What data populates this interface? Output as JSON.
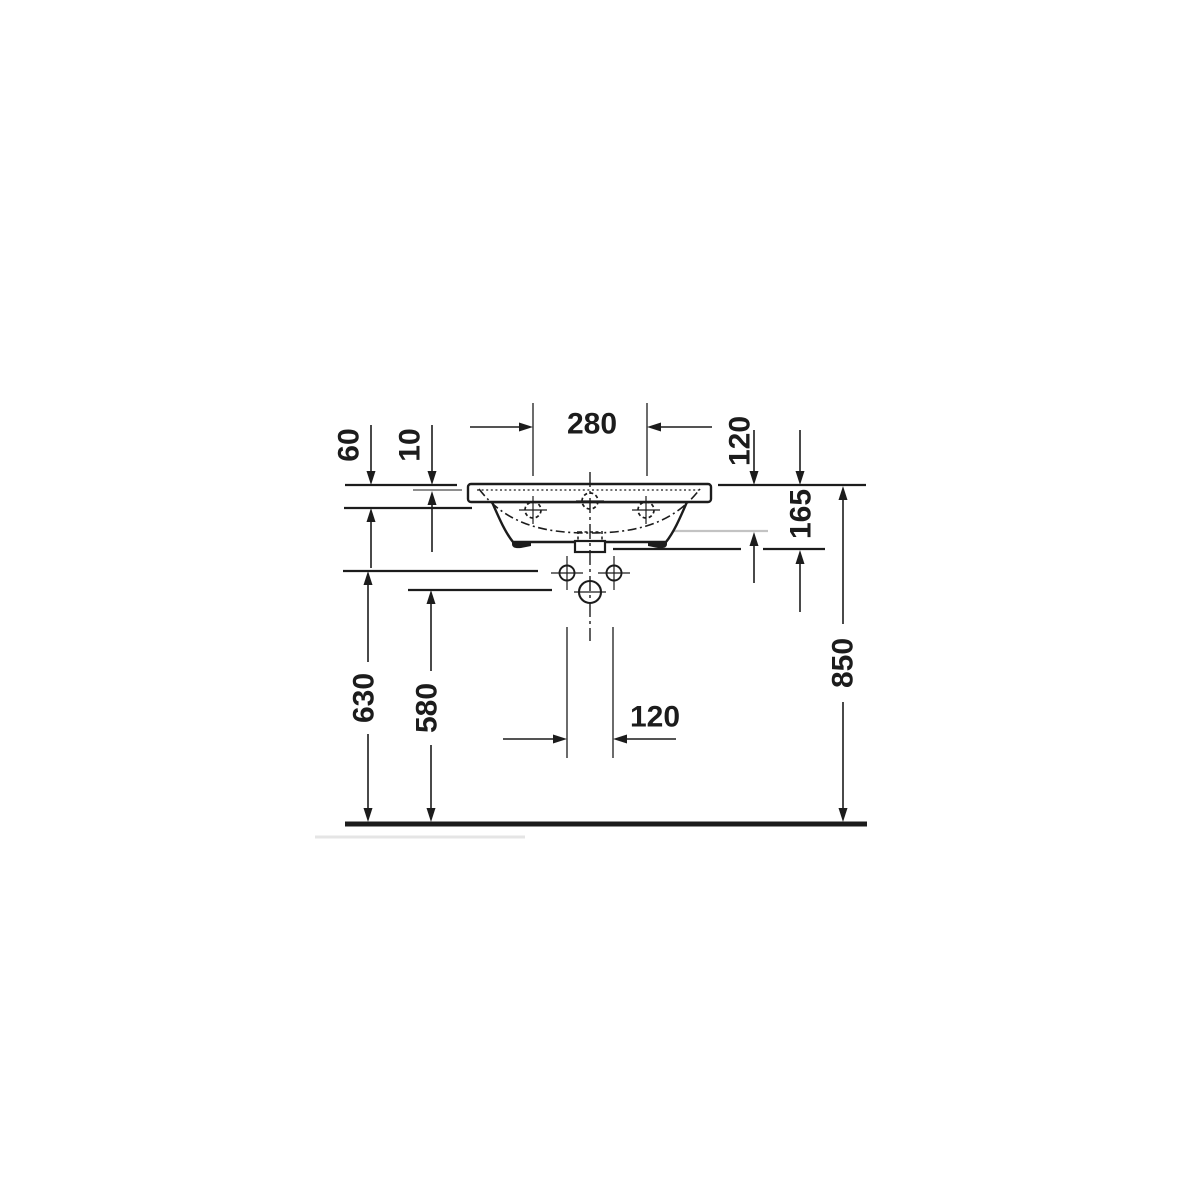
{
  "page": {
    "background": "#ffffff"
  },
  "drawing": {
    "type": "technical dimension drawing",
    "subject": "wall-mounted washbasin, front elevation with installation heights",
    "unit": "mm",
    "colors": {
      "line": "#1c1c1c",
      "reference_gray": "#c3c3c3",
      "shadow_gray": "#e5e5e5",
      "background": "#ffffff"
    },
    "dimensions": {
      "dim_280": "280",
      "dim_120_top": "120",
      "dim_60": "60",
      "dim_10": "10",
      "dim_165": "165",
      "dim_850": "850",
      "dim_630": "630",
      "dim_580": "580",
      "dim_120_bottom": "120"
    }
  }
}
